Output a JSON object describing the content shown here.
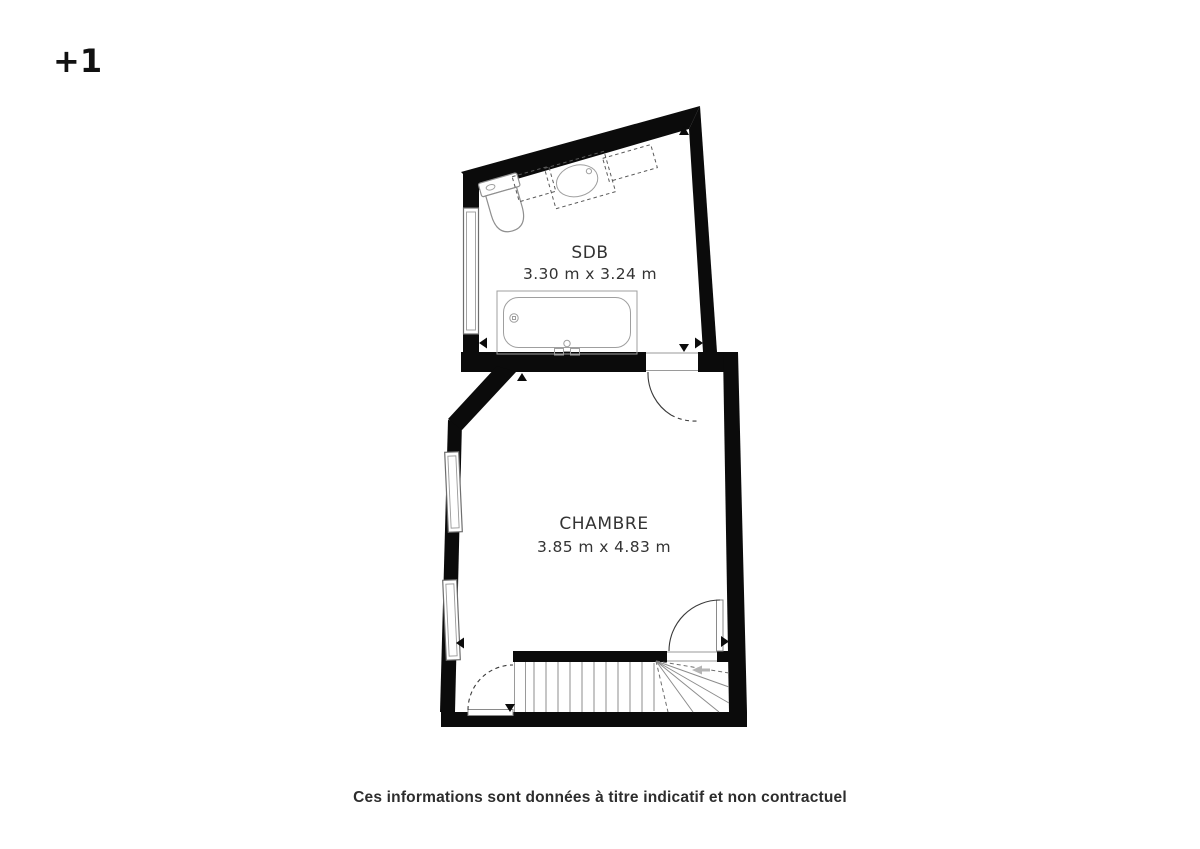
{
  "page": {
    "floor_label": "+1",
    "disclaimer": "Ces informations sont données à titre indicatif et non contractuel"
  },
  "rooms": {
    "sdb": {
      "name": "SDB",
      "dimensions": "3.30 m x 3.24 m"
    },
    "chambre": {
      "name": "CHAMBRE",
      "dimensions": "3.85 m x 4.83 m"
    }
  },
  "plan_elements": {
    "fixtures": [
      "toilet",
      "sink-vanity",
      "furniture-box-left",
      "furniture-box-right",
      "bathtub",
      "stairs-with-winders"
    ],
    "doors": [
      "sdb-to-chambre-door",
      "chambre-stairs-left-door",
      "chambre-stairs-right-door"
    ],
    "windows": [
      "sdb-left-window",
      "chambre-left-window-upper",
      "chambre-left-window-lower"
    ],
    "stair_direction_arrow": "left"
  },
  "colors": {
    "background": "#ffffff",
    "wall": "#0b0b0b",
    "text": "#2d2d2d",
    "fixture_stroke": "#8f8f8f",
    "door_stroke": "#3a3a3a",
    "direction_arrow": "#b5b5b5"
  }
}
